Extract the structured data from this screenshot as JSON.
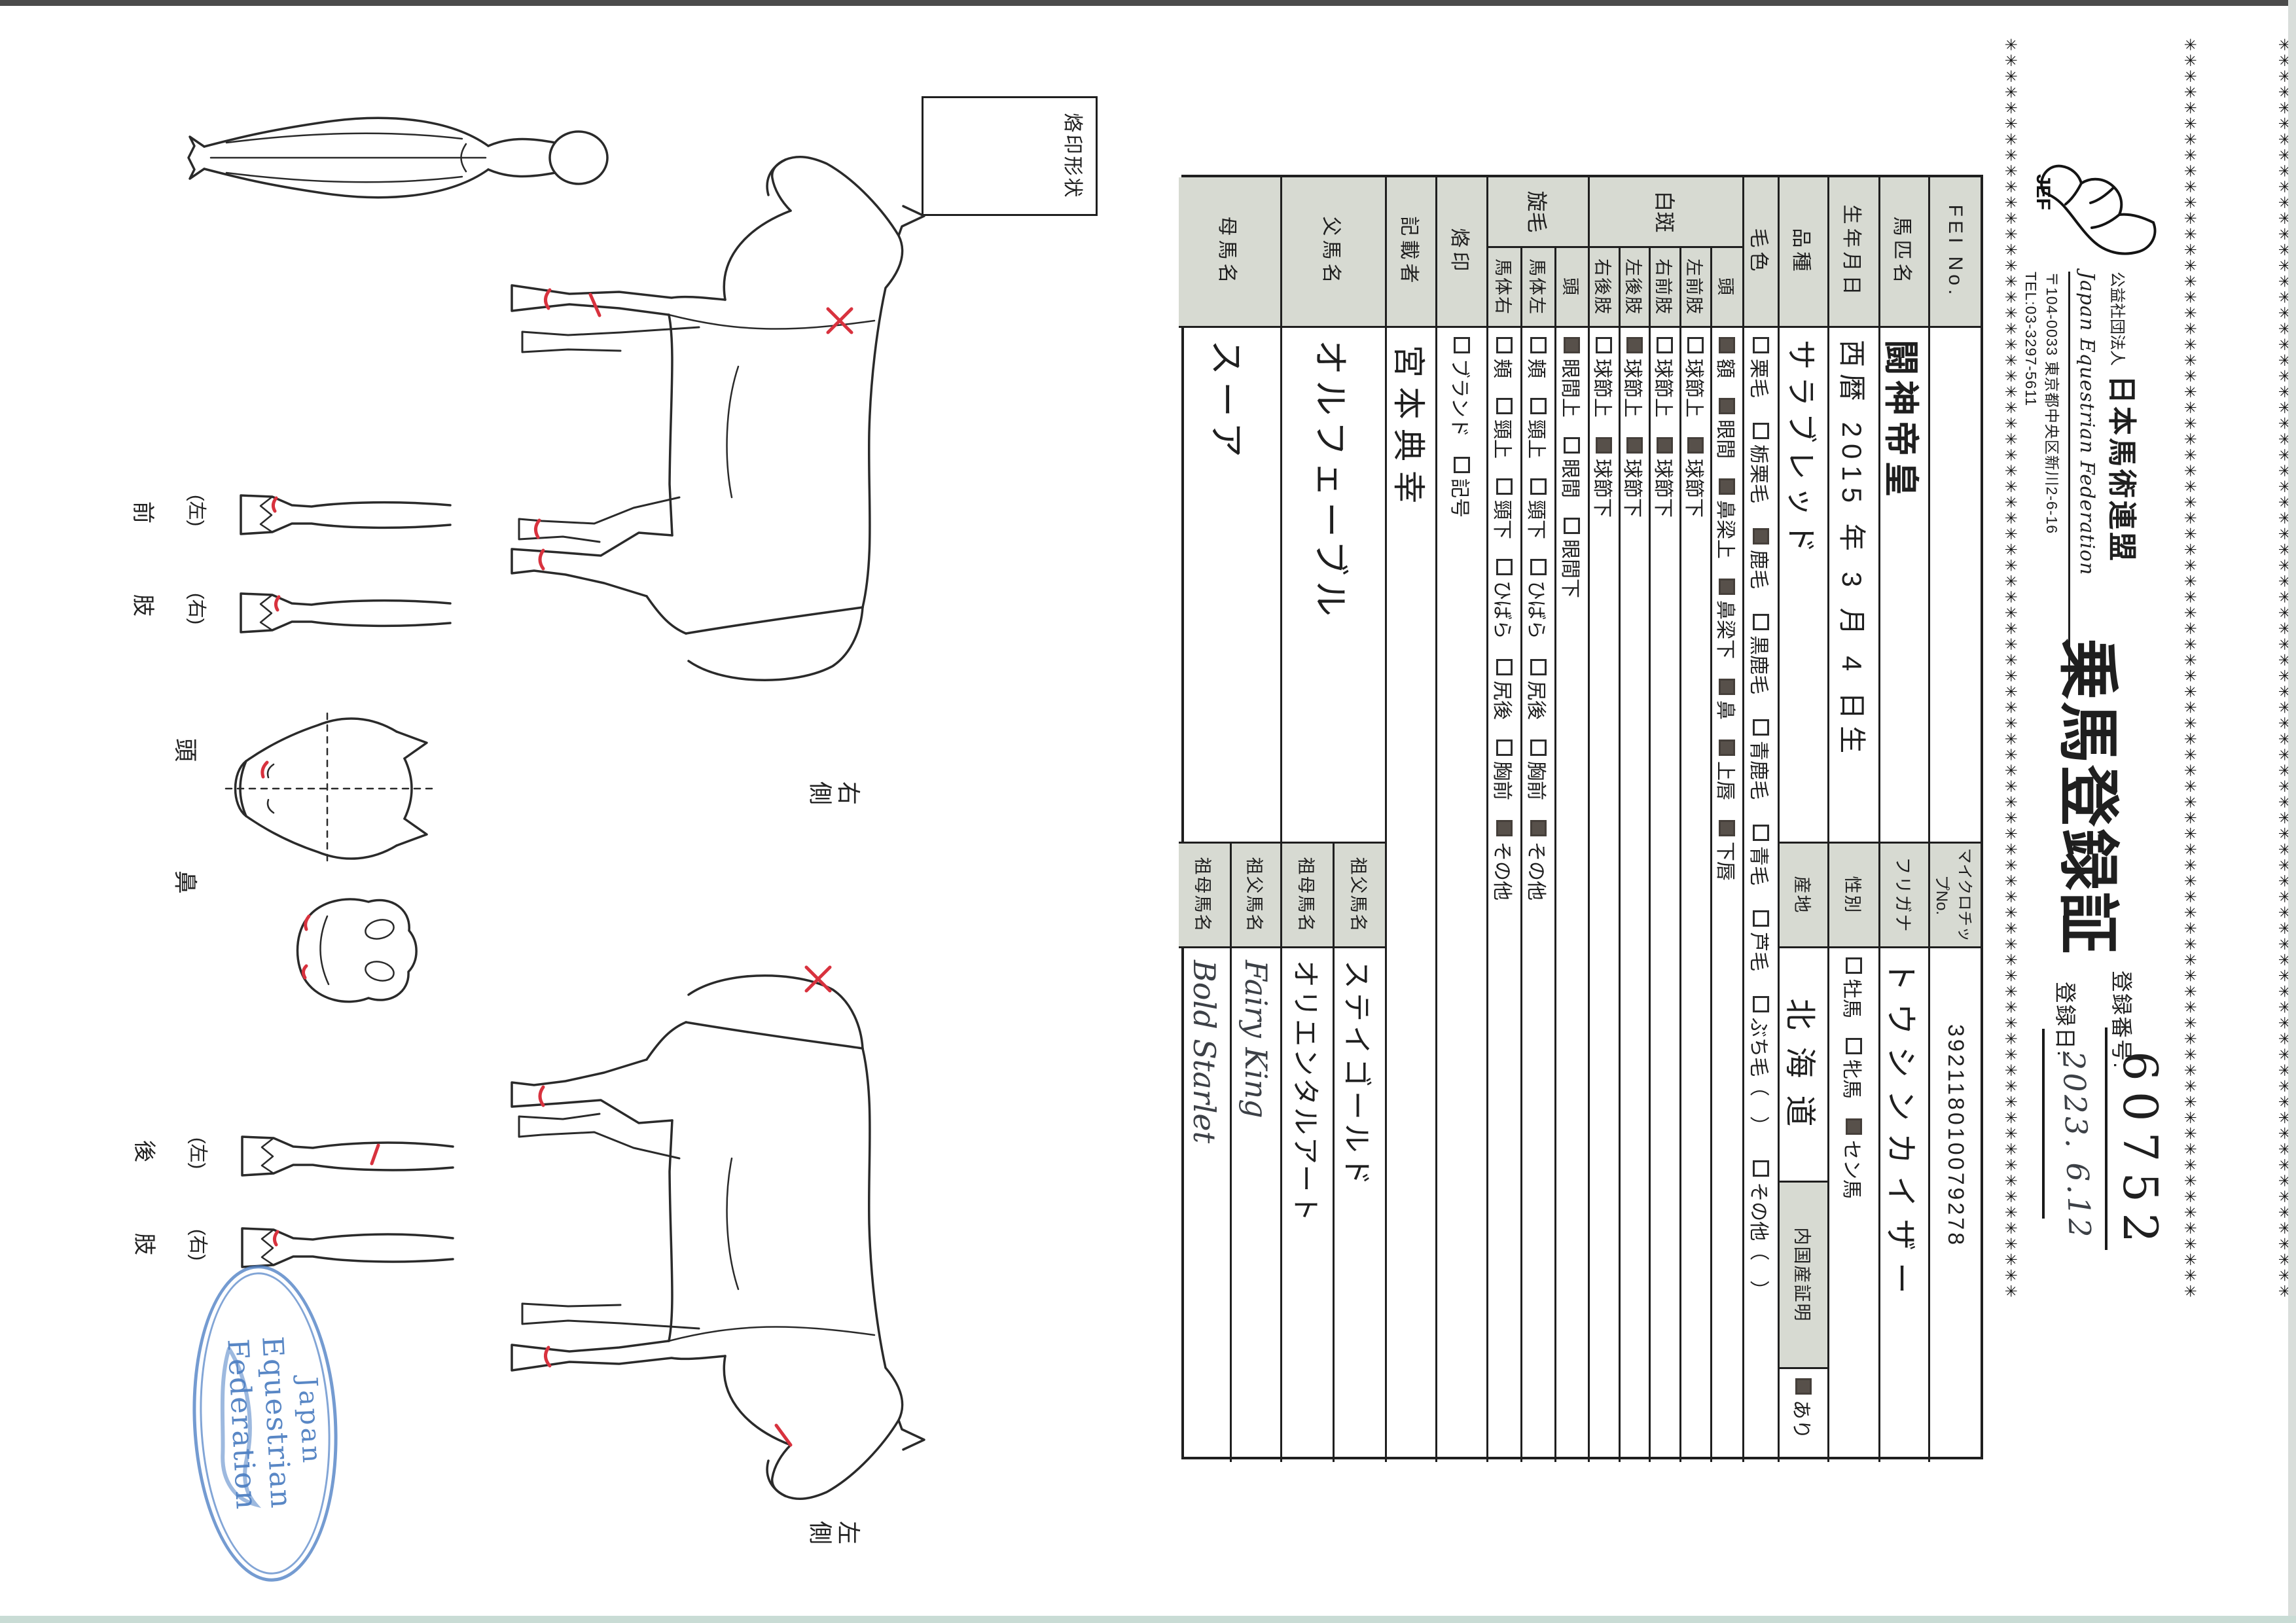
{
  "header": {
    "star_char": "✳",
    "star_count": 80,
    "title": "乗馬登録証",
    "federation": {
      "corp": "公益社団法人",
      "name": "日本馬術連盟",
      "name_en": "Japan Equestrian Federation",
      "address": "〒104-0033 東京都中央区新川2-6-16",
      "tel": "TEL:03-3297-5611",
      "logo_label": "JEF"
    },
    "registration": {
      "no_label": "登録番号:",
      "no": "60752",
      "date_label": "登録日:",
      "date": "2023. 6.12"
    }
  },
  "table": {
    "fei": {
      "label": "FEI No.",
      "value": "",
      "chip_label": "マイクロチップNo.",
      "chip_value": "392118010079278"
    },
    "name": {
      "label": "馬匹名",
      "value": "闘神帝皇",
      "kana_label": "フリガナ",
      "kana_value": "トウシンカイザー"
    },
    "birth": {
      "label": "生年月日",
      "value": "西暦 2015 年 3 月 4 日生",
      "sex_label": "性別",
      "sex_options": [
        {
          "c": false,
          "t": "牡馬"
        },
        {
          "c": false,
          "t": "牝馬"
        },
        {
          "c": true,
          "t": "セン馬"
        }
      ]
    },
    "breed": {
      "label": "品種",
      "value": "サラブレッド",
      "origin_label": "産地",
      "origin_value": "北海道",
      "domestic_label": "内国産証明",
      "domestic_options": [
        {
          "c": true,
          "t": "あり"
        }
      ]
    },
    "coat": {
      "label": "毛色",
      "options": [
        {
          "c": false,
          "t": "栗毛"
        },
        {
          "c": false,
          "t": "栃栗毛"
        },
        {
          "c": true,
          "t": "鹿毛"
        },
        {
          "c": false,
          "t": "黒鹿毛"
        },
        {
          "c": false,
          "t": "青鹿毛"
        },
        {
          "c": false,
          "t": "青毛"
        },
        {
          "c": false,
          "t": "芦毛"
        },
        {
          "c": false,
          "t": "ぶち毛（　）"
        },
        {
          "c": false,
          "t": "その他（　）"
        }
      ]
    },
    "markings": {
      "label": "白斑",
      "rows": [
        {
          "sub": "頭",
          "options": [
            {
              "c": true,
              "t": "額"
            },
            {
              "c": true,
              "t": "眼間"
            },
            {
              "c": true,
              "t": "鼻梁上"
            },
            {
              "c": true,
              "t": "鼻梁下"
            },
            {
              "c": true,
              "t": "鼻"
            },
            {
              "c": true,
              "t": "上唇"
            },
            {
              "c": true,
              "t": "下唇"
            }
          ]
        },
        {
          "sub": "左前肢",
          "options": [
            {
              "c": false,
              "t": "球節上"
            },
            {
              "c": true,
              "t": "球節下"
            }
          ]
        },
        {
          "sub": "右前肢",
          "options": [
            {
              "c": false,
              "t": "球節上"
            },
            {
              "c": true,
              "t": "球節下"
            }
          ]
        },
        {
          "sub": "左後肢",
          "options": [
            {
              "c": true,
              "t": "球節上"
            },
            {
              "c": true,
              "t": "球節下"
            }
          ]
        },
        {
          "sub": "右後肢",
          "options": [
            {
              "c": false,
              "t": "球節上"
            },
            {
              "c": true,
              "t": "球節下"
            }
          ]
        }
      ]
    },
    "whorls": {
      "label": "旋毛",
      "rows": [
        {
          "sub": "頭",
          "options": [
            {
              "c": true,
              "t": "眼間上"
            },
            {
              "c": false,
              "t": "眼間"
            },
            {
              "c": false,
              "t": "眼間下"
            }
          ]
        },
        {
          "sub": "馬体左",
          "options": [
            {
              "c": false,
              "t": "頬"
            },
            {
              "c": false,
              "t": "頸上"
            },
            {
              "c": false,
              "t": "頸下"
            },
            {
              "c": false,
              "t": "ひばら"
            },
            {
              "c": false,
              "t": "尻後"
            },
            {
              "c": false,
              "t": "胸前"
            },
            {
              "c": true,
              "t": "その他"
            }
          ]
        },
        {
          "sub": "馬体右",
          "options": [
            {
              "c": false,
              "t": "頬"
            },
            {
              "c": false,
              "t": "頸上"
            },
            {
              "c": false,
              "t": "頸下"
            },
            {
              "c": false,
              "t": "ひばら"
            },
            {
              "c": false,
              "t": "尻後"
            },
            {
              "c": false,
              "t": "胸前"
            },
            {
              "c": true,
              "t": "その他"
            }
          ]
        }
      ]
    },
    "brand": {
      "label": "烙印",
      "options": [
        {
          "c": false,
          "t": "ブランド"
        },
        {
          "c": false,
          "t": "記号"
        }
      ]
    },
    "recorder": {
      "label": "記載者",
      "value": "宮本典幸"
    },
    "sire": {
      "label": "父馬名",
      "value": "オルフェーブル",
      "gsire_label": "祖父馬名",
      "gsire_value": "ステイゴールド",
      "gdam_label": "祖母馬名",
      "gdam_value": "オリエンタルアート"
    },
    "dam": {
      "label": "母馬名",
      "value": "スーア",
      "gsire_label": "祖父馬名",
      "gsire_value": "Fairy King",
      "gdam_label": "祖母馬名",
      "gdam_value": "Bold Starlet"
    }
  },
  "diagram": {
    "box_label": "烙印形状",
    "right_view": "右側",
    "left_view": "左側",
    "head_label": "頭",
    "nose_label": "鼻",
    "front_limb": "前肢",
    "hind_limb": "後肢",
    "left_paren": "(左)",
    "right_paren": "(右)"
  },
  "stamp": {
    "line1": "Japan",
    "line2": "Equestrian",
    "line3": "Federation"
  },
  "colors": {
    "header_cell": "#d7dad2",
    "line": "#1f1f1f",
    "red_mark": "#d8323e",
    "stamp_blue": "#4d7fc4"
  }
}
